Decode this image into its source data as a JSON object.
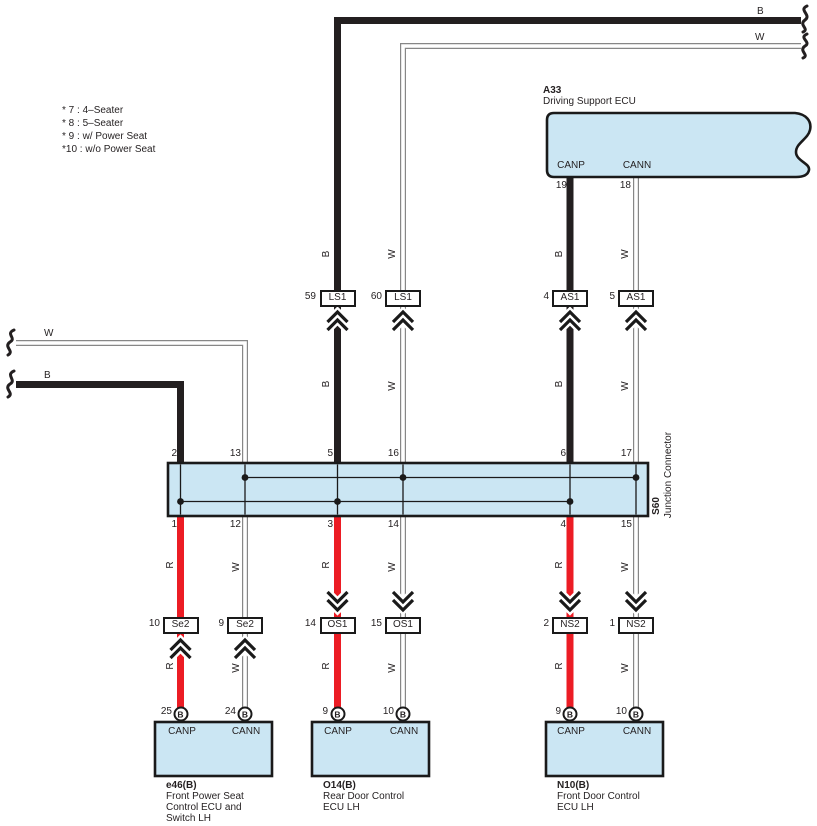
{
  "diagram": {
    "legend": {
      "items": [
        "* 7 : 4–Seater",
        "* 8 : 5–Seater",
        "* 9 : w/ Power Seat",
        "*10 : w/o Power Seat"
      ]
    },
    "wire_letters": {
      "b": "B",
      "w": "W",
      "r": "R"
    },
    "a33": {
      "id": "A33",
      "name": "Driving Support ECU",
      "canp": "CANP",
      "cann": "CANN",
      "canp_pin": "19",
      "cann_pin": "18"
    },
    "junction": {
      "id": "S60",
      "name": "Junction Connector",
      "top_pins": [
        "2",
        "13",
        "5",
        "16",
        "6",
        "17"
      ],
      "bottom_pins": [
        "1",
        "12",
        "3",
        "14",
        "4",
        "15"
      ]
    },
    "row1": [
      {
        "num": "59",
        "code": "LS1"
      },
      {
        "num": "60",
        "code": "LS1"
      },
      {
        "num": "4",
        "code": "AS1"
      },
      {
        "num": "5",
        "code": "AS1"
      }
    ],
    "row2": [
      {
        "num": "10",
        "code": "Se2"
      },
      {
        "num": "9",
        "code": "Se2"
      },
      {
        "num": "14",
        "code": "OS1"
      },
      {
        "num": "15",
        "code": "OS1"
      },
      {
        "num": "2",
        "code": "NS2"
      },
      {
        "num": "1",
        "code": "NS2"
      }
    ],
    "ecus": [
      {
        "id": "e46(B)",
        "line1": "Front Power Seat",
        "line2": "Control ECU and",
        "line3": "Switch LH",
        "pin1_num": "25",
        "pin2_num": "24",
        "terminal": "B",
        "canp": "CANP",
        "cann": "CANN"
      },
      {
        "id": "O14(B)",
        "line1": "Rear Door Control",
        "line2": "ECU LH",
        "pin1_num": "9",
        "pin2_num": "10",
        "terminal": "B",
        "canp": "CANP",
        "cann": "CANN"
      },
      {
        "id": "N10(B)",
        "line1": "Front Door Control",
        "line2": "ECU LH",
        "pin1_num": "9",
        "pin2_num": "10",
        "terminal": "B",
        "canp": "CANP",
        "cann": "CANN"
      }
    ],
    "colors": {
      "wire_black": "#231f20",
      "wire_red": "#ec1c24",
      "wire_white": "#ffffff",
      "connector_fill": "#cbe6f3"
    }
  }
}
